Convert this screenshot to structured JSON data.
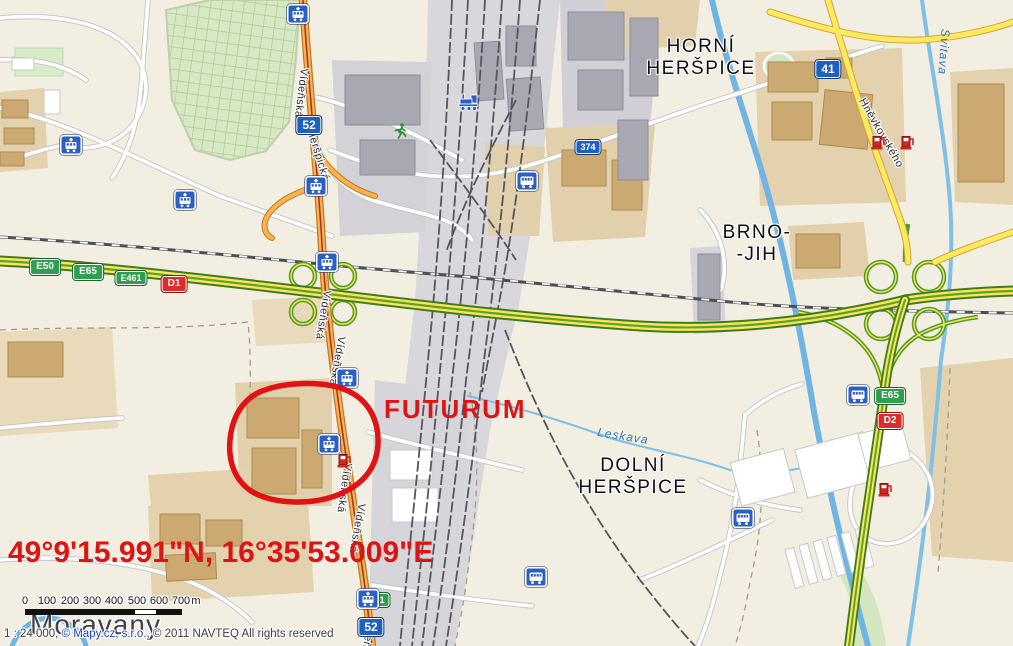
{
  "annotations": {
    "poi_label": "FUTURUM",
    "coordinates": "49°9'15.991\"N, 16°35'53.009\"E"
  },
  "places": {
    "horni_herspice": [
      "HORNÍ",
      "HERŠPICE"
    ],
    "brno_jih": [
      "BRNO-",
      "-JIH"
    ],
    "dolni_herspice": [
      "DOLNÍ",
      "HERŠPICE"
    ],
    "moravany": "Moravany"
  },
  "streets": {
    "videnska": "Vídeňská",
    "herspicka": "Heršpická",
    "hnevkovskeho": "Hněvkovského"
  },
  "waters": {
    "svitava": "Svitava",
    "leskava": "Leskava"
  },
  "road_signs": {
    "d1": "D1",
    "d2": "D2",
    "e50": "E50",
    "e65": "E65",
    "e461": "E461",
    "r52": "52",
    "r374": "374",
    "r41": "41"
  },
  "icons": {
    "tram_stop": "tram-stop-icon",
    "bus_stop": "bus-stop-icon",
    "train_station": "train-station-icon",
    "fuel_station": "fuel-station-icon",
    "sports": "runner-icon"
  },
  "scale_bar": {
    "ticks": [
      "0",
      "100",
      "200",
      "300",
      "400",
      "500",
      "600",
      "700"
    ],
    "unit": "m"
  },
  "attribution": {
    "scale": "1 : 24 000,",
    "mapycz": "© Mapy.cz, s.r.o.,",
    "rights": "© 2011 NAVTEQ All rights reserved"
  },
  "colors": {
    "annotation_red": "#dd1414",
    "motorway_green": "#4f9e2d",
    "motorway_yellow": "#ffe25a",
    "main_road_orange": "#ffb14e",
    "secondary_yellow": "#ffe95e",
    "water_blue": "#6fb4e3",
    "sign_blue": "#1f5fc2",
    "sign_green": "#2f9e4f",
    "sign_red": "#de2b2b"
  }
}
